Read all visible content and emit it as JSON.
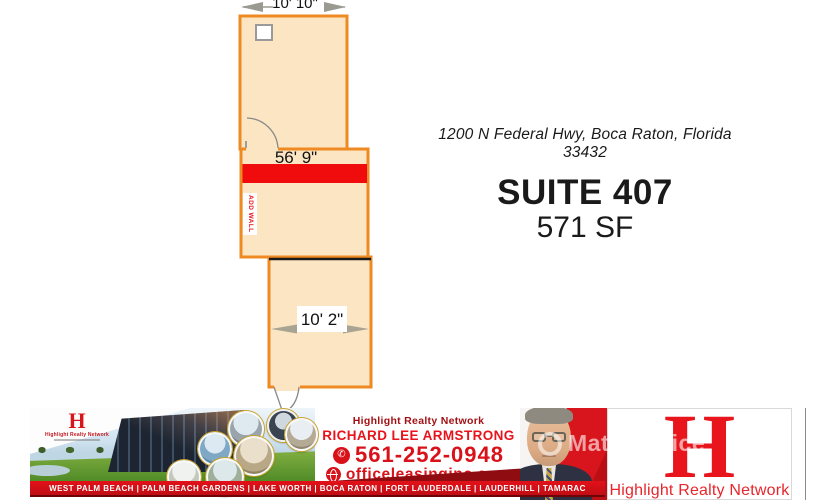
{
  "floor_plan": {
    "dim_top": "10' 10\"",
    "dim_middle": "56' 9\"",
    "dim_bottom": "10' 2\"",
    "add_wall_label": "ADD WALL",
    "colors": {
      "room_fill": "#fbe5c3",
      "wall_orange": "#ee8a21",
      "add_wall_red": "#f00c0c",
      "divider_black": "#1a1a1a"
    }
  },
  "listing": {
    "address": "1200 N Federal Hwy, Boca Raton, Florida 33432",
    "suite": "SUITE 407",
    "size": "571 SF"
  },
  "banner": {
    "mini_logo": {
      "monogram": "H",
      "name": "Highlight Realty Network"
    },
    "contact": {
      "network": "Highlight Realty Network",
      "agent": "RICHARD LEE ARMSTRONG",
      "phone": "561-252-0948",
      "website": "officeleasinginc.com",
      "phone_icon": "✆"
    },
    "watermark": "MatchOffice",
    "right_logo": {
      "monogram": "H",
      "name": "Highlight Realty Network"
    },
    "cities": [
      "WEST PALM BEACH",
      "PALM BEACH GARDENS",
      "LAKE WORTH",
      "BOCA RATON",
      "FORT LAUDERDALE",
      "LAUDERHILL",
      "TAMARAC"
    ],
    "cities_line": "WEST PALM BEACH  |  PALM BEACH GARDENS  |  LAKE WORTH  |  BOCA RATON  |  FORT LAUDERDALE  |  LAUDERHILL  |  TAMARAC",
    "colors": {
      "red": "#d9121a",
      "dark_red": "#8f0d10",
      "strip_red": "#cf0e15"
    }
  }
}
